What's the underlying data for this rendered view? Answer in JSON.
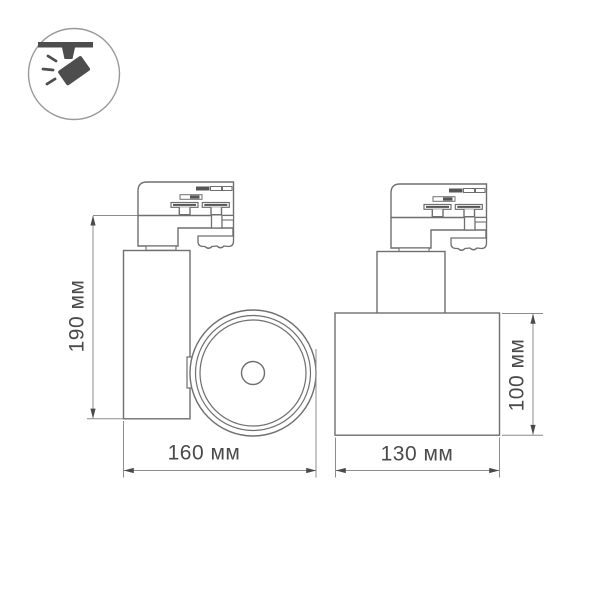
{
  "icon": {
    "name": "track-spotlight-icon",
    "description": "ceiling track spotlight pictogram in circle badge"
  },
  "views": {
    "front": {
      "name": "front-view-with-lens",
      "height_label": "190 мм",
      "width_label": "160 мм"
    },
    "side": {
      "name": "side-view",
      "height_label": "100 мм",
      "width_label": "130 мм"
    }
  },
  "colors": {
    "outline": "#6f6f6f",
    "dimension_line": "#8c8c8c",
    "dark_fill": "#565656",
    "label_text": "#4a4a4a",
    "icon_glyph": "#4d4d4d",
    "background": "#ffffff"
  }
}
